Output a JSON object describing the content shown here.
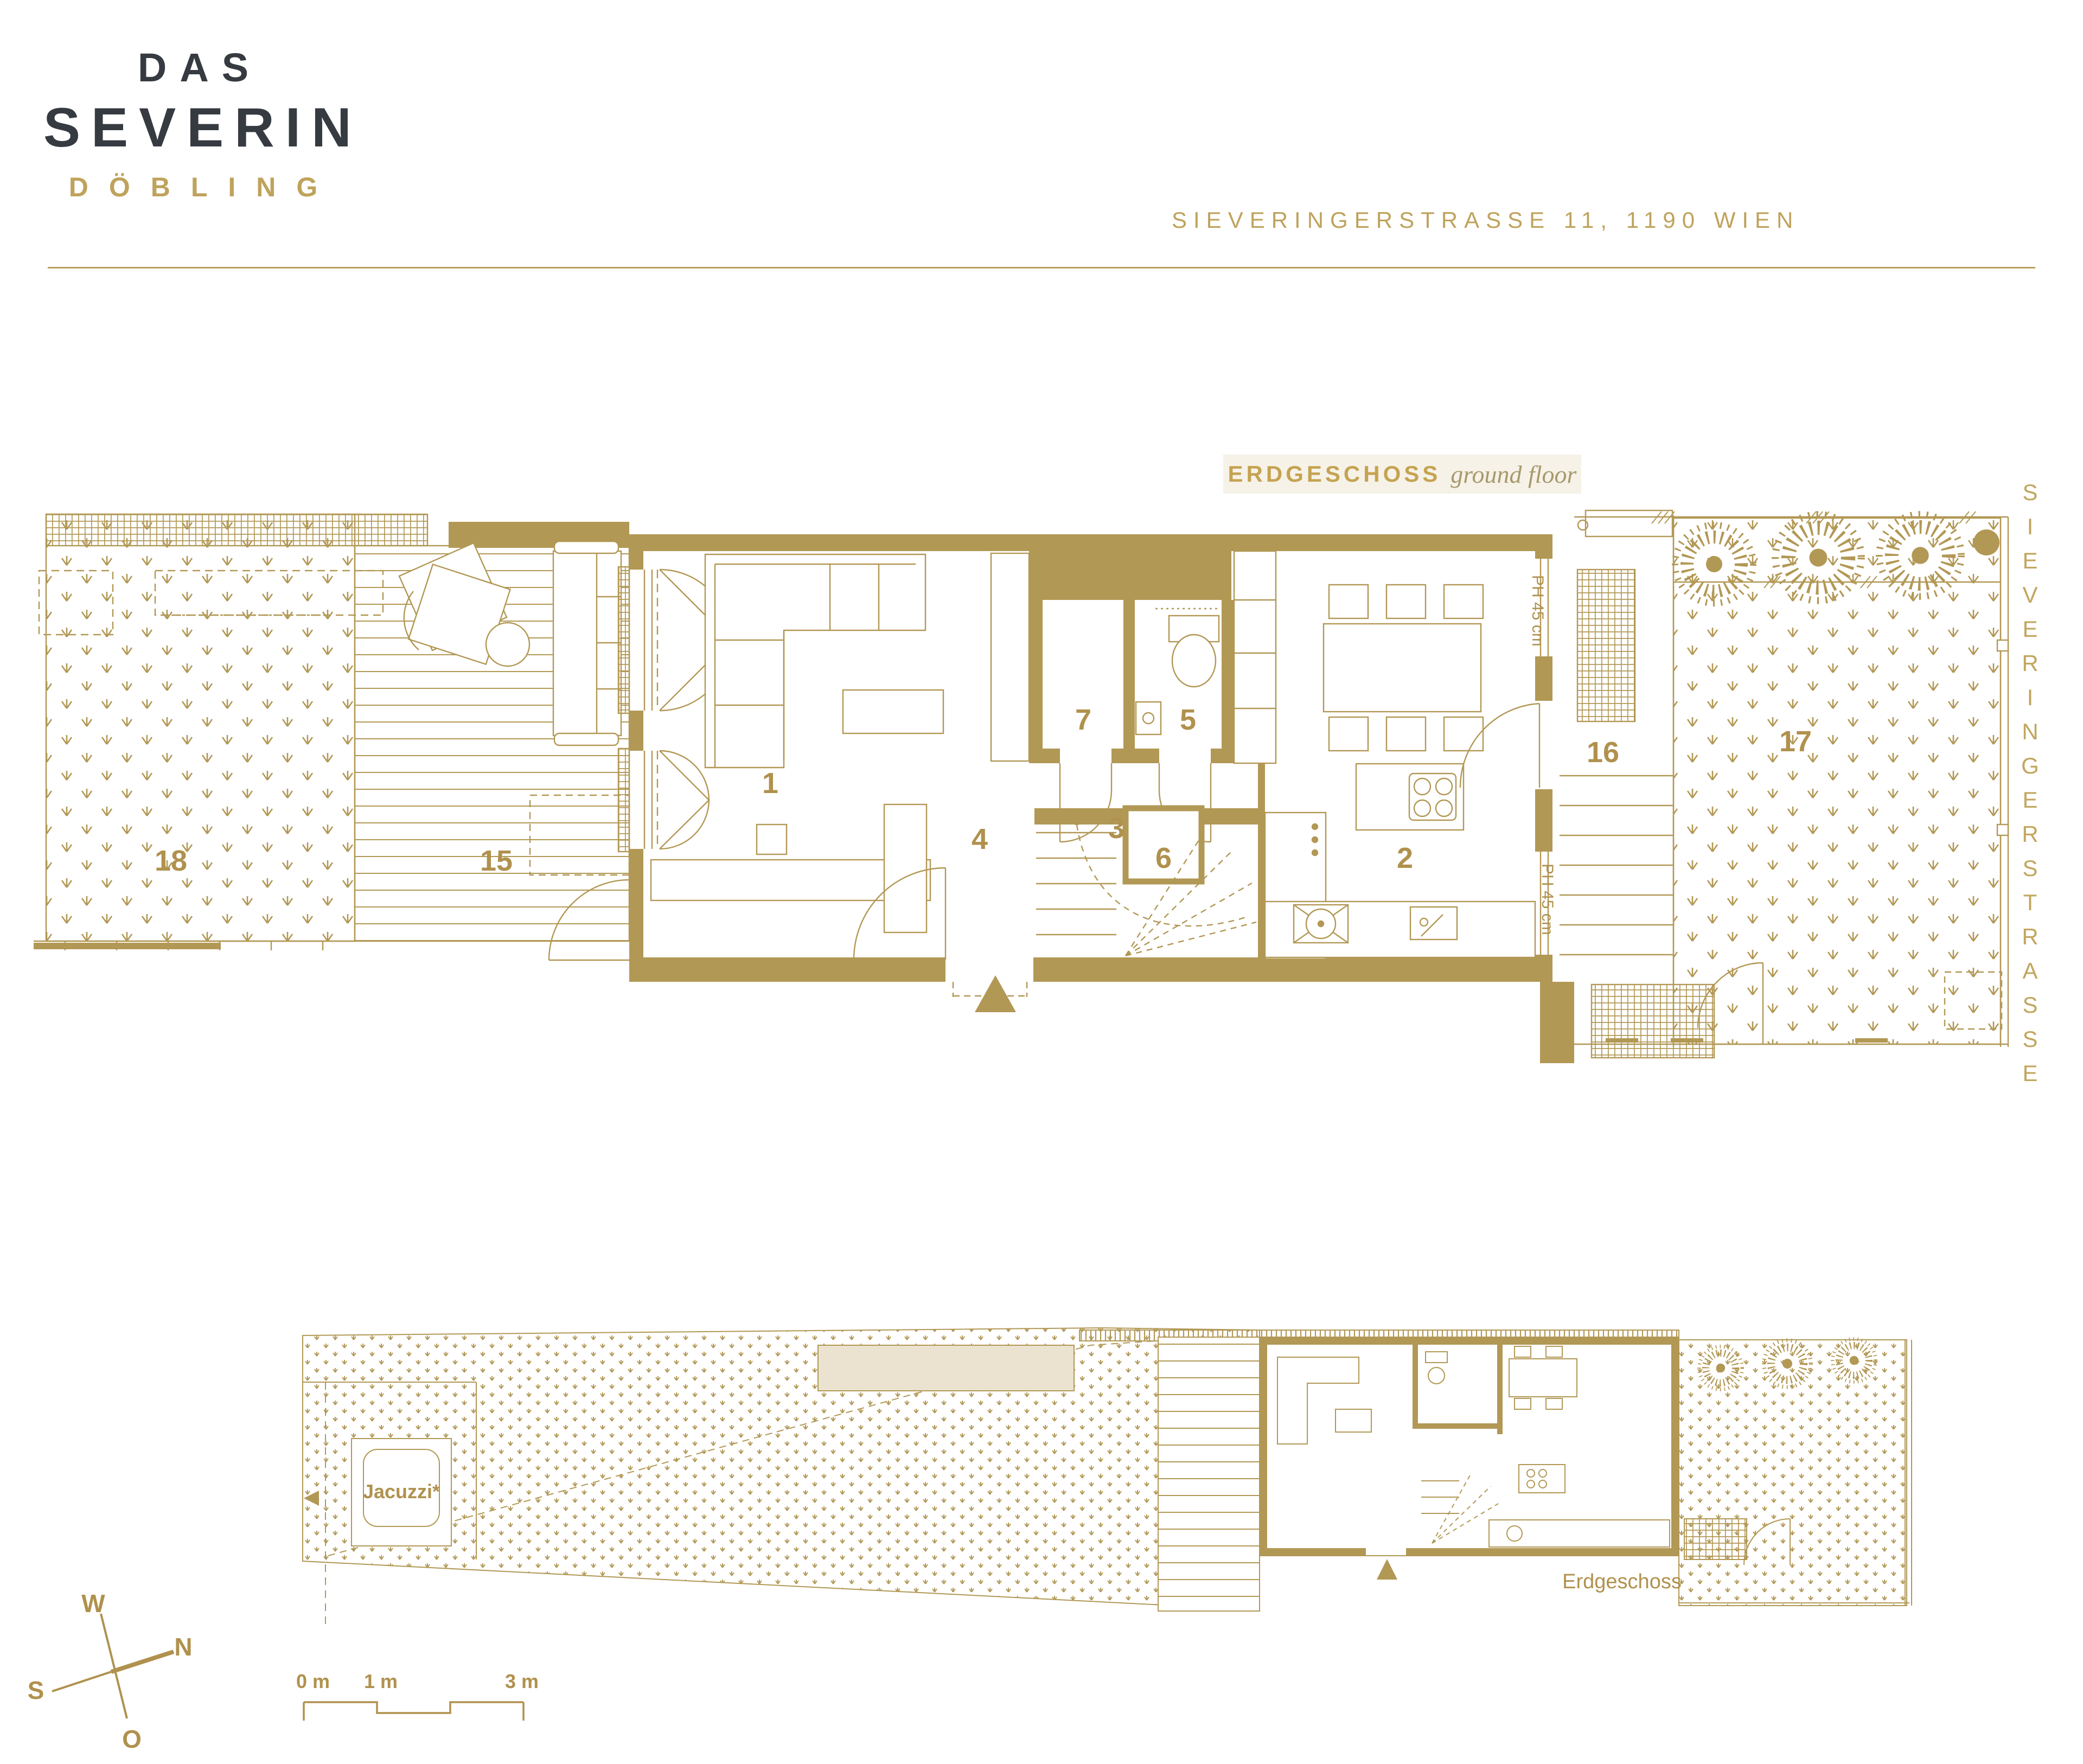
{
  "header": {
    "brand_top": "DAS",
    "brand_main": "SEVERIN",
    "brand_sub": "DÖBLING",
    "address": "SIEVERINGERSTRASSE 11, 1190 WIEN"
  },
  "plan_title": {
    "de": "ERDGESCHOSS",
    "en": "ground floor"
  },
  "street_name": "SIEVERINGERSTRASSE",
  "room_labels": {
    "living_room": "1",
    "kitchen_dining": "2",
    "hallway": "3",
    "entry_hall": "4",
    "wc": "5",
    "staircase": "6",
    "storage": "7",
    "terrace": "15",
    "entry_steps": "16",
    "front_garden": "17",
    "garden": "18"
  },
  "annotations": {
    "parapet_upper": "PH 45 cm",
    "parapet_lower": "PH 45 cm",
    "jacuzzi": "Jacuzzi*",
    "site_floor_label": "Erdgeschoss"
  },
  "compass": {
    "west": "W",
    "north": "N",
    "south": "S",
    "east": "O"
  },
  "scale_bar": {
    "zero": "0 m",
    "one": "1 m",
    "three": "3 m"
  },
  "colors": {
    "gold": "#b29855",
    "gold_text": "#b0914d",
    "dark": "#363b42",
    "chip_bg": "#f6f2e8",
    "beige": "#ebe3cf"
  }
}
